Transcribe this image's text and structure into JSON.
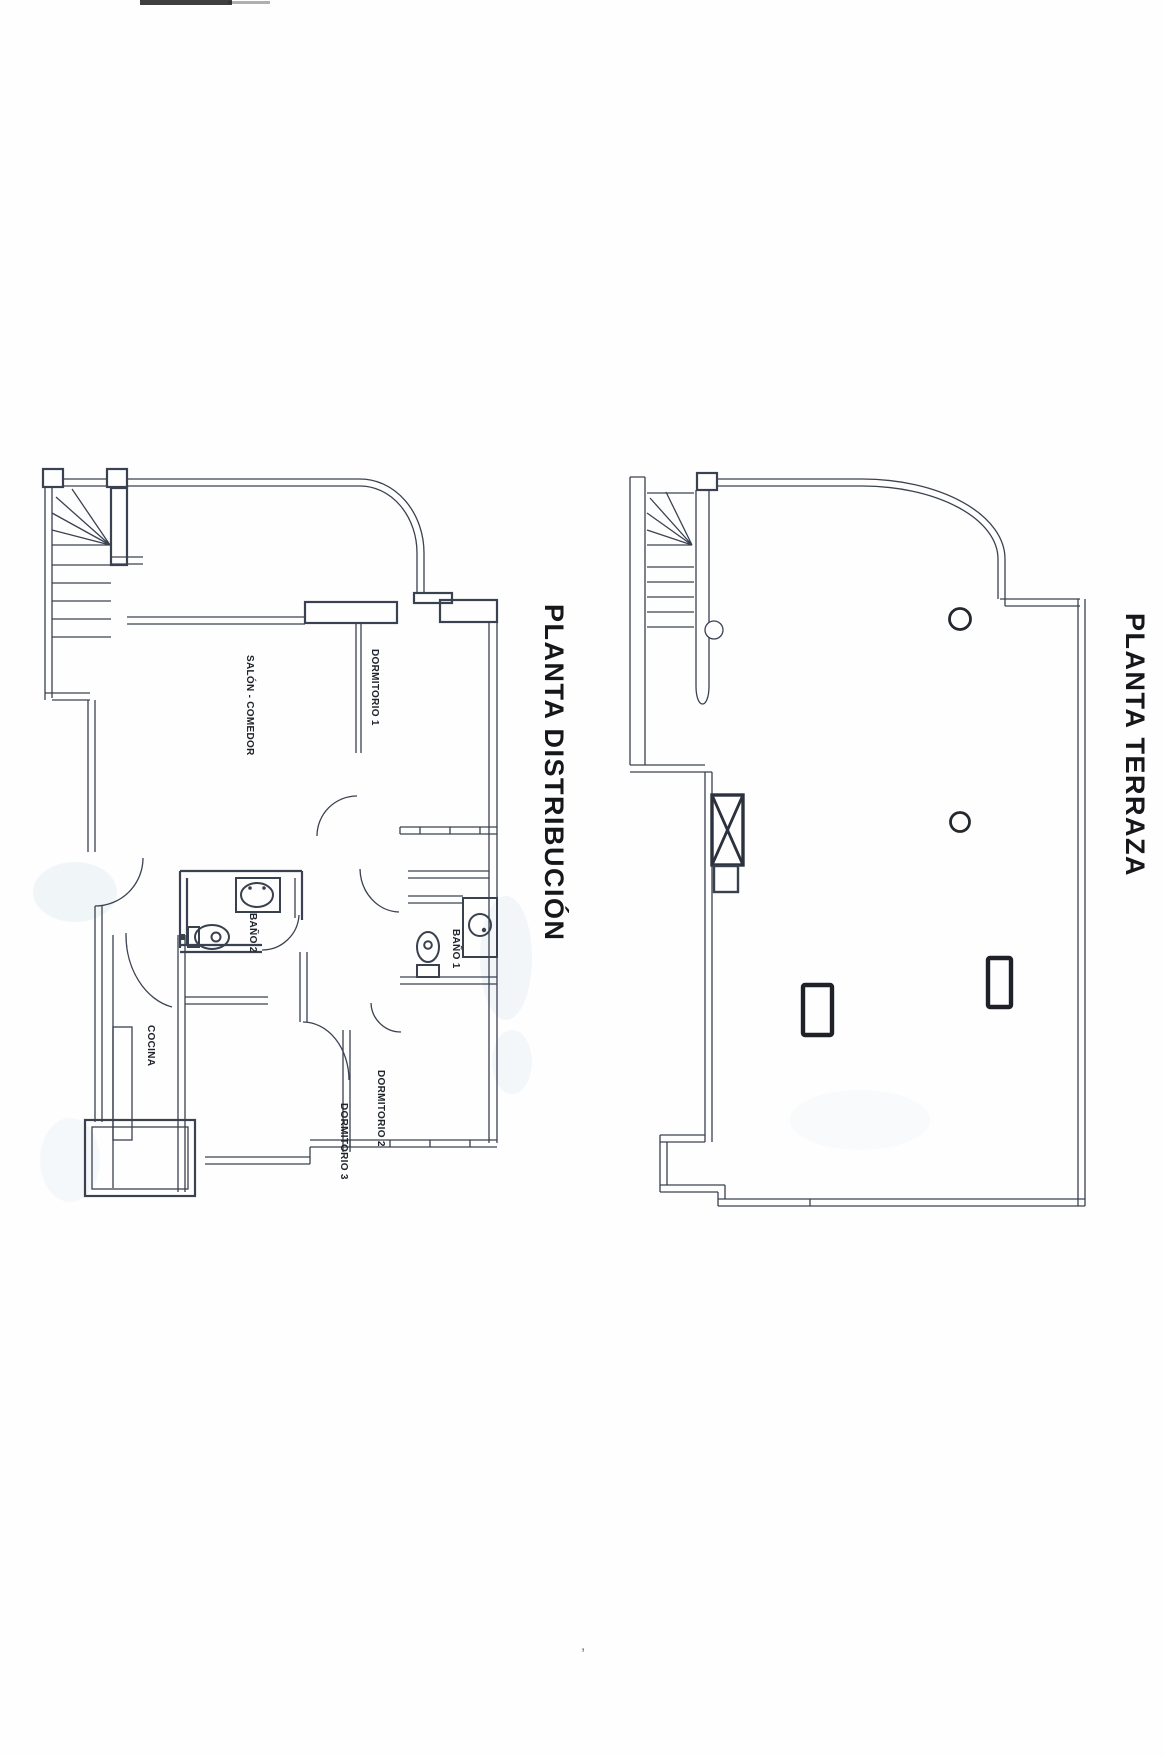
{
  "page": {
    "kind": "scanned architectural floor plan sheet",
    "paper_color": "#fefefe",
    "ink_color": "#3a4150",
    "label_color": "#20242c"
  },
  "plans": {
    "distribucion": {
      "title": "PLANTA DISTRIBUCIÓN",
      "rooms": {
        "salon": "SALÓN - COMEDOR",
        "dormitorio1": "DORMITORIO 1",
        "bano2": "BAÑO 2",
        "bano1": "BAÑO 1",
        "cocina": "COCINA",
        "dormitorio2": "DORMITORIO 2",
        "dormitorio3": "DORMITORIO 3"
      }
    },
    "terraza": {
      "title": "PLANTA TERRAZA"
    }
  },
  "artifacts": {
    "stray_mark": ","
  }
}
